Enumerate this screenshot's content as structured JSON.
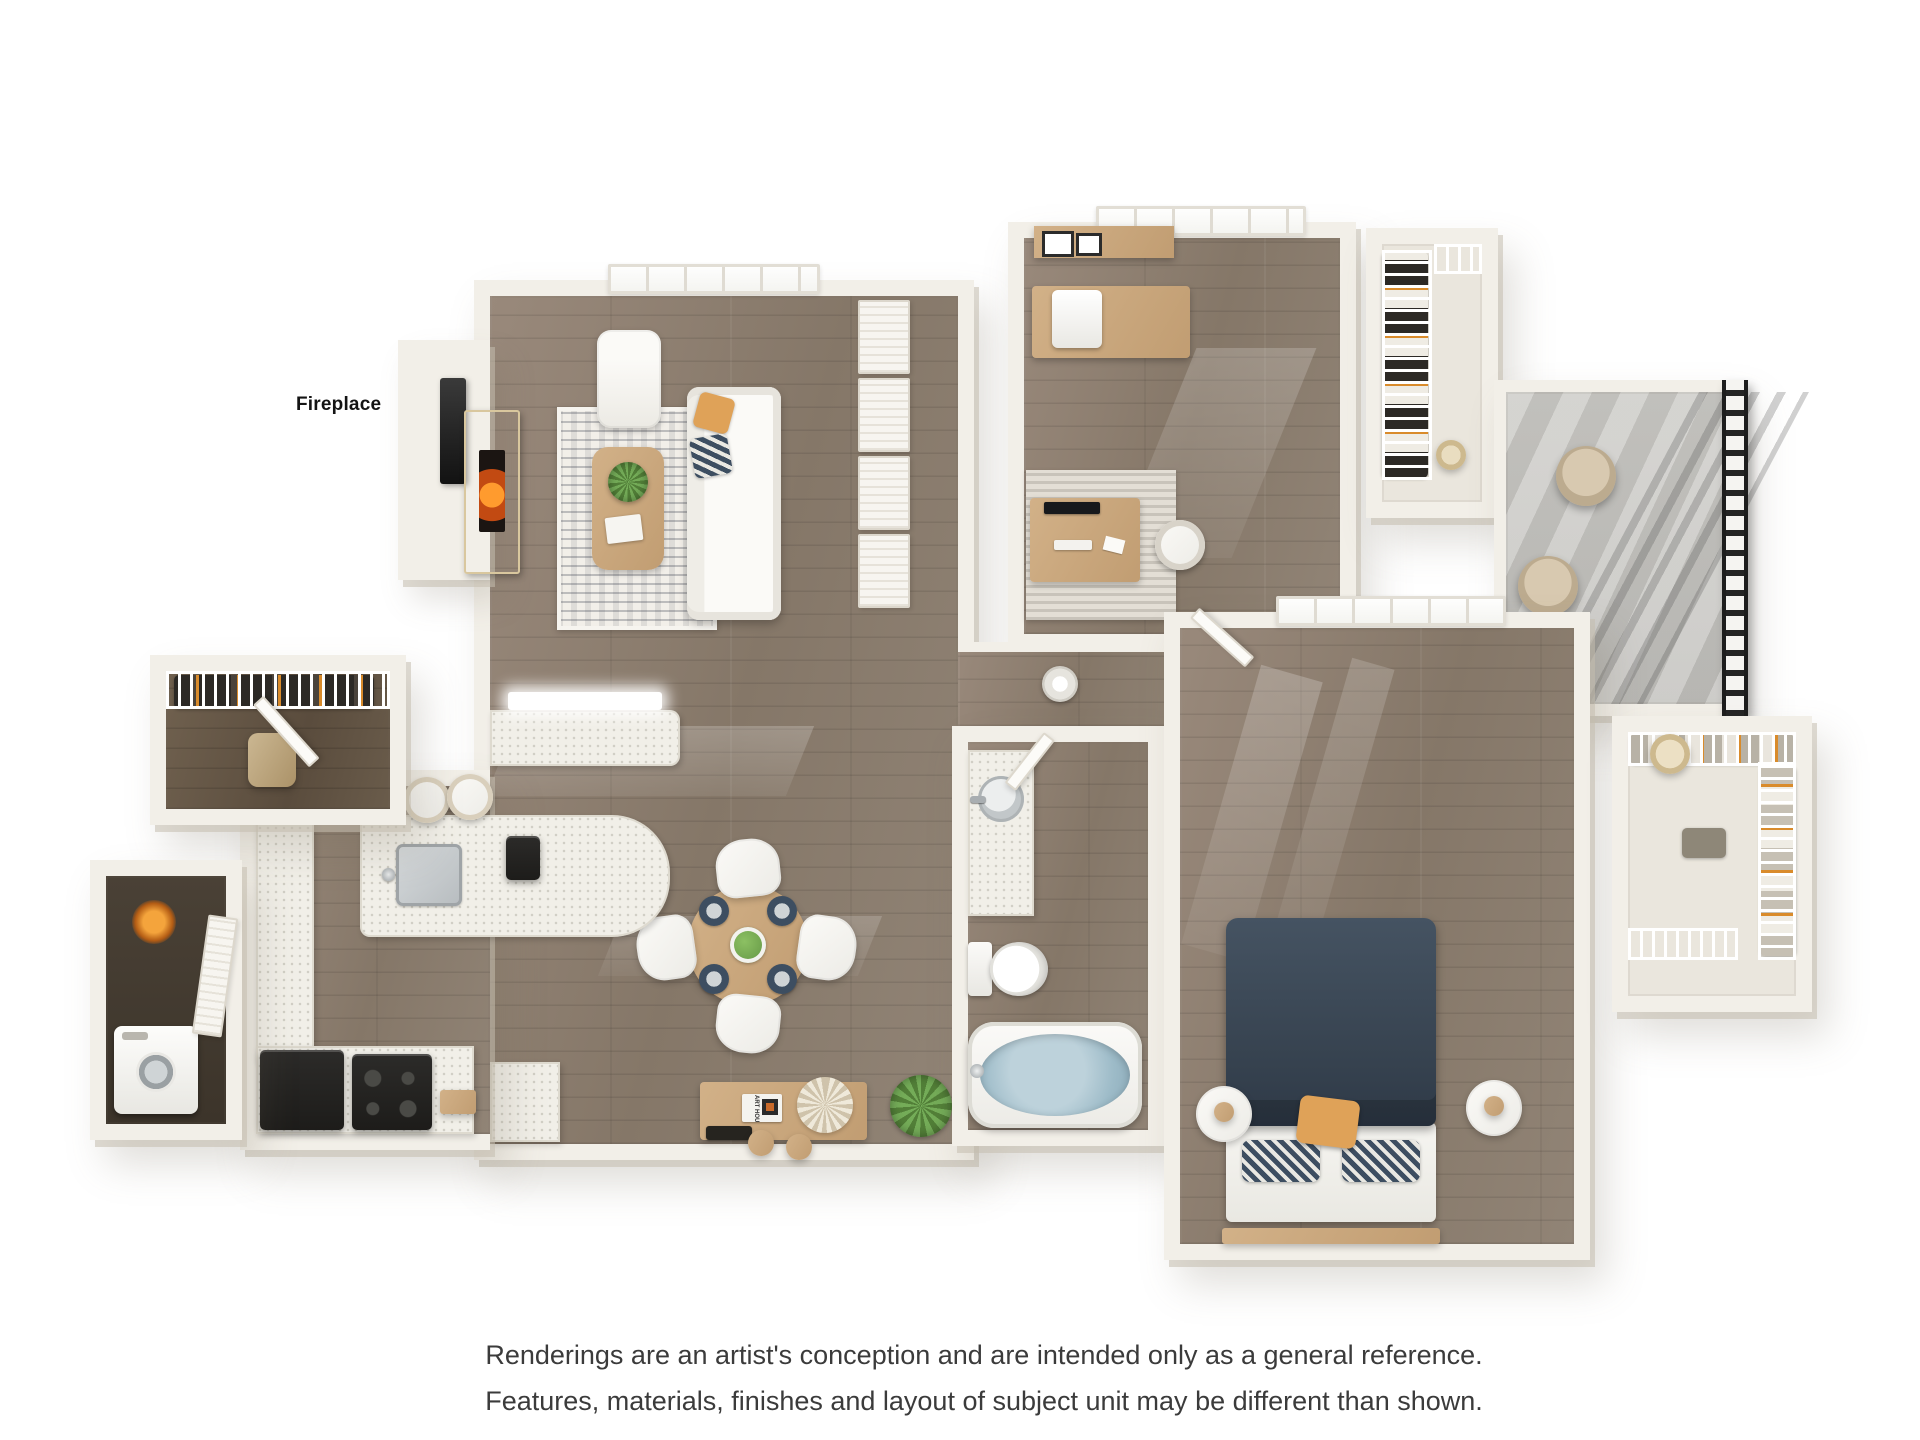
{
  "labels": {
    "fireplace": "Fireplace",
    "art_book": "ART HOUSE"
  },
  "disclaimer": {
    "line1": "Renderings are an artist's conception and are intended only as a general reference.",
    "line2": "Features, materials, finishes and layout of subject unit may be different than shown."
  },
  "palette": {
    "background": "#ffffff",
    "wall": "#f2efe8",
    "wall_edge": "#dcd7cc",
    "wood_floor_light": "#99897b",
    "wood_floor_dark": "#5a4c3d",
    "counter_speckle": "#f1efe8",
    "balcony_concrete": "#c7c6c2",
    "railing_black": "#242424",
    "appliance_black": "#232220",
    "accent_orange": "#dfa258",
    "accent_navy": "#3d4e61",
    "wood_furniture": "#c8a77d",
    "plant_green": "#6ca84f",
    "tub_water": "#a6c2cf",
    "text_dark": "#3b3b3b"
  },
  "rooms": {
    "living_room": {
      "items": [
        "window",
        "fireplace",
        "tv",
        "armchair",
        "sofa",
        "throw-pillow-orange",
        "throw-pillow-navy",
        "coffee-table",
        "potted-plant",
        "book",
        "area-rug",
        "closet-doors",
        "peninsula-counter"
      ]
    },
    "kitchen": {
      "items": [
        "island",
        "sink",
        "faucet",
        "stand-mixer",
        "bar-stool",
        "bar-stool",
        "refrigerator",
        "range",
        "cutting-board",
        "counters"
      ]
    },
    "dining_area": {
      "items": [
        "dining-table",
        "dining-chair",
        "dining-chair",
        "dining-chair",
        "dining-chair",
        "place-setting",
        "place-setting",
        "place-setting",
        "place-setting",
        "centerpiece"
      ]
    },
    "console_nook": {
      "items": [
        "console-table",
        "art-book",
        "dried-flowers",
        "serving-tray",
        "stool",
        "stool",
        "floor-plant"
      ]
    },
    "entry": {
      "items": [
        "entry-door",
        "wire-shelving",
        "hanging-clothes",
        "duffel-bag"
      ]
    },
    "utility_closet": {
      "items": [
        "washer",
        "louvered-door",
        "water-heater-glow"
      ]
    },
    "office": {
      "items": [
        "window",
        "wall-shelf",
        "picture-frame",
        "picture-frame",
        "dresser",
        "printer",
        "area-rug",
        "desk",
        "monitor",
        "keyboard",
        "desk-chair",
        "door"
      ]
    },
    "office_closet": {
      "items": [
        "wire-shelving",
        "hanging-clothes",
        "hat"
      ]
    },
    "balcony": {
      "items": [
        "patio-chair",
        "patio-chair",
        "railing",
        "potted-plant"
      ]
    },
    "hallway": {
      "items": [
        "pendant-lamp"
      ]
    },
    "bathroom": {
      "items": [
        "vanity",
        "sink",
        "faucet",
        "toilet",
        "bathtub",
        "tub-faucet",
        "door"
      ]
    },
    "bedroom": {
      "items": [
        "window",
        "bed",
        "duvet",
        "sheet",
        "pillow",
        "pillow",
        "accent-pillow",
        "headboard",
        "nightstand",
        "nightstand",
        "door"
      ]
    },
    "walk_in_closet": {
      "items": [
        "wire-shelving",
        "hanging-clothes",
        "hamper"
      ]
    }
  }
}
